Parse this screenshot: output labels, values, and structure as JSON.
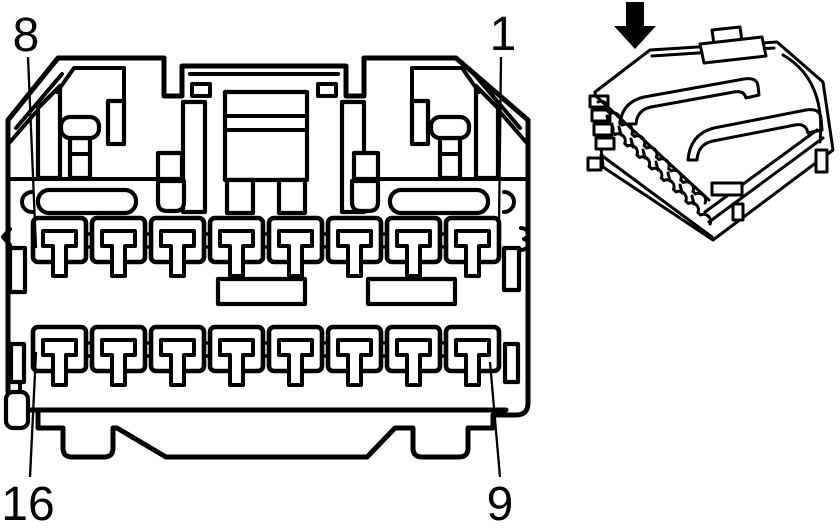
{
  "colors": {
    "line": "#000000",
    "background": "#ffffff"
  },
  "front_view": {
    "description": "connector front view",
    "rows": 2,
    "pins_per_row": 8,
    "pin_labels": [
      {
        "label": "8",
        "position": "top-left"
      },
      {
        "label": "1",
        "position": "top-right"
      },
      {
        "label": "16",
        "position": "bottom-left"
      },
      {
        "label": "9",
        "position": "bottom-right"
      }
    ]
  },
  "iso_view": {
    "description": "connector isometric view",
    "arrow_icon": "down-arrow"
  }
}
